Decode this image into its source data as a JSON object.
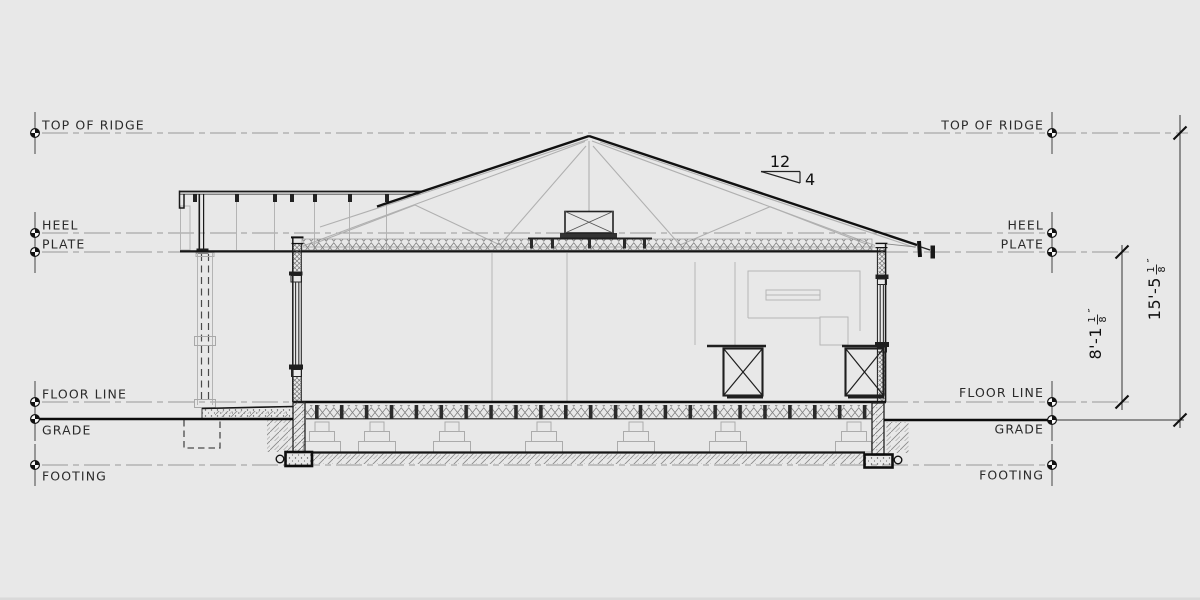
{
  "drawing": {
    "datum_labels": {
      "top_of_ridge": "TOP OF RIDGE",
      "heel": "HEEL",
      "plate": "PLATE",
      "floor_line": "FLOOR LINE",
      "grade": "GRADE",
      "footing": "FOOTING"
    },
    "dimensions": {
      "plate_to_floor": {
        "label": "8'-1 1/8\"",
        "whole": "8'-1",
        "numerator": "1",
        "denominator": "8",
        "unit_mark": "″"
      },
      "ridge_to_grade": {
        "label": "15'-5 1/8\"",
        "whole": "15'-5",
        "numerator": "1",
        "denominator": "8",
        "unit_mark": "″"
      }
    },
    "roof_pitch": {
      "run": "12",
      "rise": "4"
    },
    "colors": {
      "background": "#e8e8e8",
      "ink": "#1a1a1a",
      "light_line": "#b4b4b4",
      "dash_line": "#999999"
    }
  }
}
